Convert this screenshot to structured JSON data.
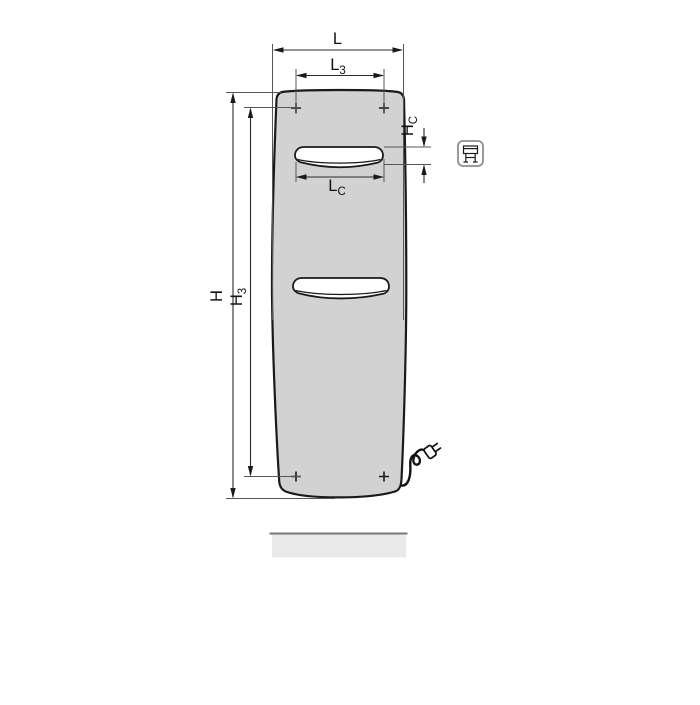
{
  "drawing": {
    "description": "panel radiator front-view dimensional drawing",
    "dim_L": {
      "base": "L",
      "sub": ""
    },
    "dim_L3": {
      "base": "L",
      "sub": "3"
    },
    "dim_LC": {
      "base": "L",
      "sub": "C"
    },
    "dim_H": {
      "base": "H",
      "sub": ""
    },
    "dim_H3": {
      "base": "H",
      "sub": "3"
    },
    "dim_HC": {
      "base": "H",
      "sub": "C"
    }
  },
  "icons": {
    "profile_icon": "radiator-profile-icon"
  },
  "colors": {
    "background": "#ffffff",
    "panel_fill": "#d2d2d2",
    "outline": "#1a1a1a",
    "dimension_line": "#2b2b2b",
    "extension_line": "#565656",
    "floor_bar_fill": "#e9e9e9",
    "floor_bar_edge": "#787878",
    "icon_border": "#8f8f8f"
  }
}
